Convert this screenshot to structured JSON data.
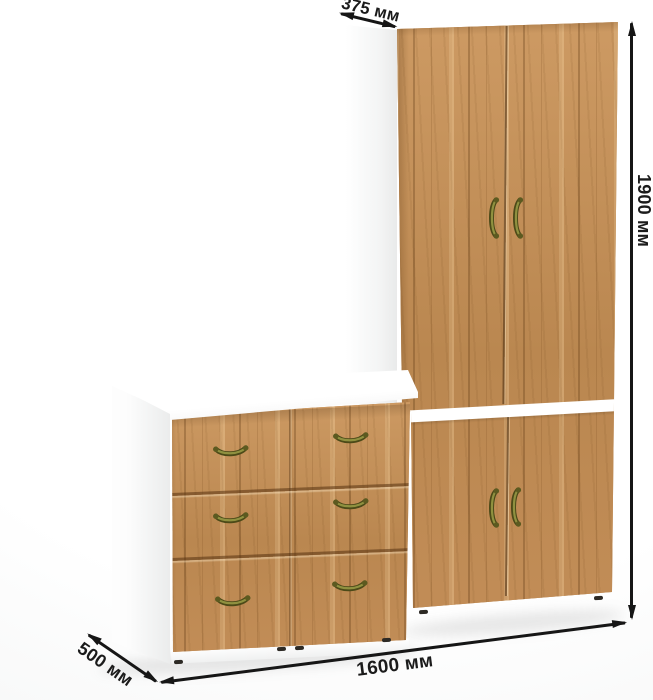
{
  "annotations": {
    "depth_top": "375 мм",
    "height": "1900 мм",
    "depth_side": "500 мм",
    "width": "1600 мм"
  },
  "colors": {
    "wood_base": "#c18c56",
    "wood_light": "#d6a66c",
    "wood_dark": "#8e6437",
    "carcass": "#ffffff",
    "handle_brass": "#8f9140",
    "handle_brass_dark": "#4c4a18",
    "annotation_text": "#1b1b1b",
    "background": "#ffffff"
  }
}
